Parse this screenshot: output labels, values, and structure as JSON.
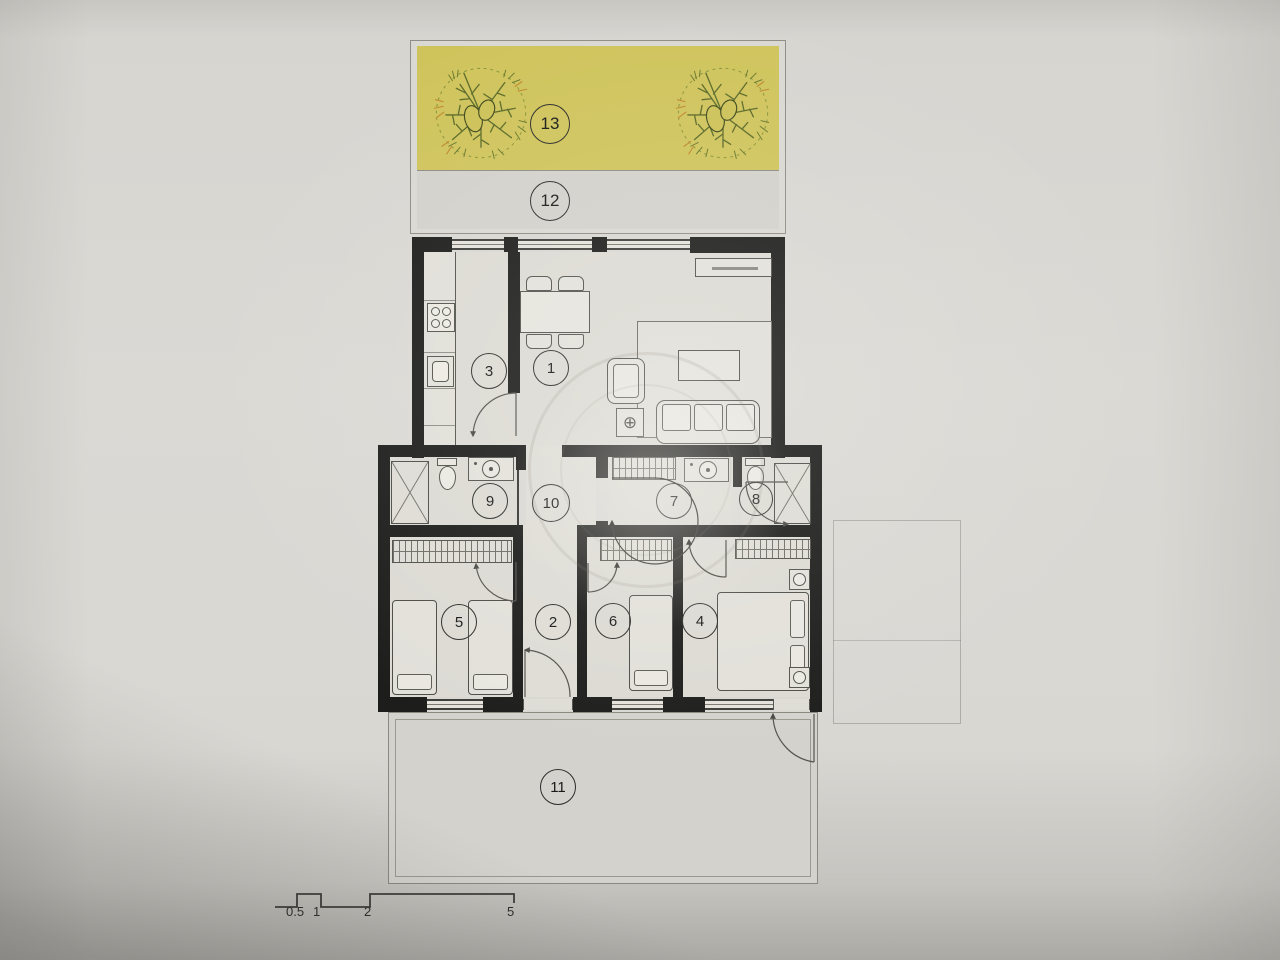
{
  "plan": {
    "type": "apartment-floor-plan",
    "rooms": {
      "r1": {
        "label": "1"
      },
      "r2": {
        "label": "2"
      },
      "r3": {
        "label": "3"
      },
      "r4": {
        "label": "4"
      },
      "r5": {
        "label": "5"
      },
      "r6": {
        "label": "6"
      },
      "r7": {
        "label": "7"
      },
      "r8": {
        "label": "8"
      },
      "r9": {
        "label": "9"
      },
      "r10": {
        "label": "10"
      },
      "r11": {
        "label": "11"
      },
      "r12": {
        "label": "12"
      },
      "r13": {
        "label": "13"
      }
    },
    "scale_bar": {
      "ticks": [
        "0.5",
        "1",
        "2",
        "5"
      ]
    },
    "icons": {
      "crosshair_glyph": "⊕",
      "tree": "tree-icon"
    },
    "colors": {
      "garden_fill": "#cfc45c",
      "terrace_fill": "#d3d1cb",
      "floor_fill": "#dcdad3",
      "wall": "#1d1d1b",
      "paper": "#d8d6d1"
    }
  }
}
